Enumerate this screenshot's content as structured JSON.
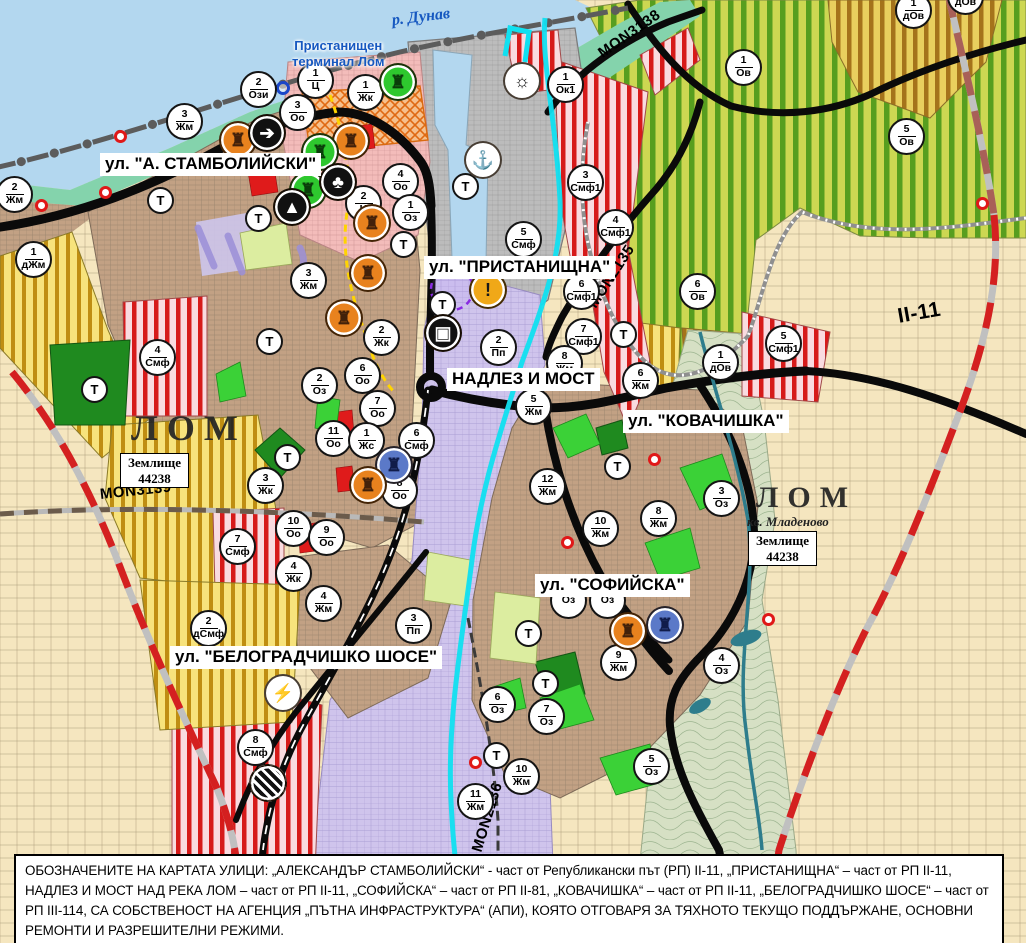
{
  "palette": {
    "water": "#b3d7ef",
    "shore_green": "#84d3ac",
    "farmland": "#f5e6bf",
    "residential_brown": "#c2a184",
    "center_pink": "#f3bcba",
    "industry_purple": "#cfc4ec",
    "mixed_red_stripe": "#d61a1a",
    "vineyard_green": "#579e1f",
    "road_black": "#0a0a0a",
    "road_red_dash": "#d42020",
    "river_cyan": "#10e0f0"
  },
  "map": {
    "labels": [
      {
        "name": "river-label",
        "cls": "lbl-river",
        "t": "р. Дунав",
        "x": 392,
        "y": 12,
        "rotate": -7
      },
      {
        "name": "port-terminal-label",
        "cls": "lbl-port",
        "t": "Пристанищен\nтерминал Лом",
        "x": 292,
        "y": 38
      },
      {
        "name": "street-label",
        "cls": "lbl-street",
        "t": "ул. \"А. СТАМБОЛИЙСКИ\"",
        "x": 100,
        "y": 153
      },
      {
        "name": "street-label",
        "cls": "lbl-street",
        "t": "ул. \"ПРИСТАНИЩНА\"",
        "x": 424,
        "y": 256
      },
      {
        "name": "street-label",
        "cls": "lbl-street",
        "t": "НАДЛЕЗ И МОСТ",
        "x": 447,
        "y": 368
      },
      {
        "name": "street-label",
        "cls": "lbl-street",
        "t": "ул. \"КОВАЧИШКА\"",
        "x": 623,
        "y": 410
      },
      {
        "name": "street-label",
        "cls": "lbl-street",
        "t": "ул. \"СОФИЙСКА\"",
        "x": 535,
        "y": 574
      },
      {
        "name": "street-label",
        "cls": "lbl-street",
        "t": "ул. \"БЕЛОГРАДЧИШКО ШОСЕ\"",
        "x": 170,
        "y": 646
      },
      {
        "name": "road-label",
        "cls": "lbl-road",
        "t": "MON3138",
        "x": 600,
        "y": 46,
        "rotate": -35
      },
      {
        "name": "road-label",
        "cls": "lbl-road",
        "t": "MON2135",
        "x": 592,
        "y": 298,
        "rotate": -57
      },
      {
        "name": "road-label",
        "cls": "lbl-road lbl-road-xl",
        "t": "II-11",
        "x": 898,
        "y": 305,
        "rotate": -10
      },
      {
        "name": "road-label",
        "cls": "lbl-road",
        "t": "MON3139",
        "x": 100,
        "y": 486,
        "rotate": -6
      },
      {
        "name": "road-label",
        "cls": "lbl-road",
        "t": "MON2136",
        "x": 477,
        "y": 843,
        "rotate": -73
      },
      {
        "name": "city-label",
        "cls": "lbl-city",
        "t": "ЛОМ",
        "x": 131,
        "y": 408,
        "size": 36
      },
      {
        "name": "city-label",
        "cls": "lbl-city",
        "t": "ЛОМ",
        "x": 756,
        "y": 481,
        "size": 30
      },
      {
        "name": "district-label",
        "cls": "lbl-district",
        "t": "кв. Младеново",
        "x": 747,
        "y": 515
      },
      {
        "name": "landplot-label",
        "cls": "lbl-plot",
        "t": "Землище\n44238",
        "x": 120,
        "y": 453
      },
      {
        "name": "landplot-label",
        "cls": "lbl-plot",
        "t": "Землище\n44238",
        "x": 748,
        "y": 531
      }
    ],
    "zone_markers": [
      {
        "num": "2",
        "code": "Ози",
        "x": 258,
        "y": 89
      },
      {
        "num": "1",
        "code": "Ц",
        "x": 315,
        "y": 80
      },
      {
        "num": "1",
        "code": "Жк",
        "x": 365,
        "y": 92
      },
      {
        "num": "3",
        "code": "Оо",
        "x": 297,
        "y": 112
      },
      {
        "num": "3",
        "code": "Жм",
        "x": 184,
        "y": 121
      },
      {
        "num": "2",
        "code": "Жм",
        "x": 14,
        "y": 194
      },
      {
        "num": "1",
        "code": "дЖм",
        "x": 33,
        "y": 259
      },
      {
        "num": "4",
        "code": "Оо",
        "x": 400,
        "y": 181
      },
      {
        "num": "2",
        "code": "Ц",
        "x": 363,
        "y": 203
      },
      {
        "num": "1",
        "code": "Оз",
        "x": 410,
        "y": 212
      },
      {
        "num": "1",
        "code": "Ок1",
        "x": 565,
        "y": 84
      },
      {
        "num": "3",
        "code": "Смф1",
        "x": 585,
        "y": 182
      },
      {
        "num": "4",
        "code": "Смф1",
        "x": 615,
        "y": 227
      },
      {
        "num": "5",
        "code": "Смф",
        "x": 523,
        "y": 239
      },
      {
        "num": "1",
        "code": "Ов",
        "x": 743,
        "y": 67
      },
      {
        "num": "1",
        "code": "дОв",
        "x": 913,
        "y": 10
      },
      {
        "num": "1",
        "code": "дОв",
        "x": 965,
        "y": -4
      },
      {
        "num": "5",
        "code": "Ов",
        "x": 906,
        "y": 136
      },
      {
        "num": "6",
        "code": "Ов",
        "x": 697,
        "y": 291
      },
      {
        "num": "6",
        "code": "Смф1",
        "x": 581,
        "y": 291
      },
      {
        "num": "7",
        "code": "Смф1",
        "x": 583,
        "y": 336
      },
      {
        "num": "5",
        "code": "Смф1",
        "x": 783,
        "y": 343
      },
      {
        "num": "1",
        "code": "дОв",
        "x": 720,
        "y": 362
      },
      {
        "num": "6",
        "code": "Жм",
        "x": 640,
        "y": 380
      },
      {
        "num": "2",
        "code": "Пп",
        "x": 498,
        "y": 347
      },
      {
        "num": "8",
        "code": "Жм",
        "x": 564,
        "y": 363
      },
      {
        "num": "5",
        "code": "Жм",
        "x": 533,
        "y": 406
      },
      {
        "num": "12",
        "code": "Жм",
        "x": 547,
        "y": 486
      },
      {
        "num": "8",
        "code": "Жм",
        "x": 658,
        "y": 518
      },
      {
        "num": "3",
        "code": "Оз",
        "x": 721,
        "y": 498
      },
      {
        "num": "10",
        "code": "Жм",
        "x": 600,
        "y": 528
      },
      {
        "num": "2",
        "code": "Жк",
        "x": 381,
        "y": 337
      },
      {
        "num": "6",
        "code": "Оо",
        "x": 362,
        "y": 375
      },
      {
        "num": "2",
        "code": "Оз",
        "x": 319,
        "y": 385
      },
      {
        "num": "7",
        "code": "Оо",
        "x": 377,
        "y": 408
      },
      {
        "num": "11",
        "code": "Оо",
        "x": 333,
        "y": 438
      },
      {
        "num": "1",
        "code": "Жс",
        "x": 366,
        "y": 440
      },
      {
        "num": "6",
        "code": "Смф",
        "x": 416,
        "y": 440
      },
      {
        "num": "8",
        "code": "Оо",
        "x": 399,
        "y": 490
      },
      {
        "num": "3",
        "code": "Жк",
        "x": 265,
        "y": 485
      },
      {
        "num": "3",
        "code": "Жм",
        "x": 308,
        "y": 280
      },
      {
        "num": "10",
        "code": "Оо",
        "x": 293,
        "y": 528
      },
      {
        "num": "9",
        "code": "Оо",
        "x": 326,
        "y": 537
      },
      {
        "num": "4",
        "code": "Жк",
        "x": 293,
        "y": 573
      },
      {
        "num": "4",
        "code": "Жм",
        "x": 323,
        "y": 603
      },
      {
        "num": "7",
        "code": "Смф",
        "x": 237,
        "y": 546
      },
      {
        "num": "4",
        "code": "Смф",
        "x": 157,
        "y": 357
      },
      {
        "num": "2",
        "code": "дСмф",
        "x": 208,
        "y": 628
      },
      {
        "num": "3",
        "code": "Пп",
        "x": 413,
        "y": 625
      },
      {
        "num": "8",
        "code": "Смф",
        "x": 255,
        "y": 747
      },
      {
        "num": "9",
        "code": "Жм",
        "x": 618,
        "y": 662
      },
      {
        "num": "4",
        "code": "Оз",
        "x": 721,
        "y": 665
      },
      {
        "num": "6",
        "code": "Оз",
        "x": 497,
        "y": 704
      },
      {
        "num": "7",
        "code": "Оз",
        "x": 546,
        "y": 716
      },
      {
        "num": "10",
        "code": "Жм",
        "x": 521,
        "y": 776
      },
      {
        "num": "11",
        "code": "Жм",
        "x": 475,
        "y": 801
      },
      {
        "num": "5",
        "code": "Оз",
        "x": 651,
        "y": 766
      },
      {
        "num": "",
        "code": "Оз",
        "x": 568,
        "y": 600
      },
      {
        "num": "",
        "code": "Оз",
        "x": 607,
        "y": 600
      }
    ],
    "t_markers": [
      {
        "t": "Т",
        "x": 160,
        "y": 200
      },
      {
        "t": "Т",
        "x": 258,
        "y": 218
      },
      {
        "t": "Т",
        "x": 94,
        "y": 389
      },
      {
        "t": "Т",
        "x": 287,
        "y": 457
      },
      {
        "t": "Т",
        "x": 269,
        "y": 341
      },
      {
        "t": "Т",
        "x": 403,
        "y": 244
      },
      {
        "t": "Т",
        "x": 442,
        "y": 304
      },
      {
        "t": "Т",
        "x": 465,
        "y": 186
      },
      {
        "t": "Т",
        "x": 623,
        "y": 334
      },
      {
        "t": "Т",
        "x": 617,
        "y": 466
      },
      {
        "t": "Т",
        "x": 528,
        "y": 633
      },
      {
        "t": "Т",
        "x": 545,
        "y": 683
      },
      {
        "t": "Т",
        "x": 496,
        "y": 755
      }
    ],
    "icon_markers": [
      {
        "name": "monument-icon",
        "glyph": "♜",
        "bg": "#e8821e",
        "fg": "#42210a",
        "x": 238,
        "y": 140
      },
      {
        "name": "monument-icon",
        "glyph": "♜",
        "bg": "#e8821e",
        "fg": "#42210a",
        "x": 351,
        "y": 141
      },
      {
        "name": "monument-icon",
        "glyph": "♜",
        "bg": "#e8821e",
        "fg": "#42210a",
        "x": 372,
        "y": 223
      },
      {
        "name": "monument-icon",
        "glyph": "♜",
        "bg": "#e8821e",
        "fg": "#42210a",
        "x": 368,
        "y": 273
      },
      {
        "name": "monument-icon",
        "glyph": "♜",
        "bg": "#e8821e",
        "fg": "#42210a",
        "x": 344,
        "y": 318
      },
      {
        "name": "monument-icon",
        "glyph": "♜",
        "bg": "#2ec82e",
        "fg": "#0a3d0a",
        "x": 398,
        "y": 82
      },
      {
        "name": "monument-icon",
        "glyph": "♜",
        "bg": "#2ec82e",
        "fg": "#0a3d0a",
        "x": 320,
        "y": 152
      },
      {
        "name": "monument-icon",
        "glyph": "♜",
        "bg": "#2ec82e",
        "fg": "#0a3d0a",
        "x": 308,
        "y": 190
      },
      {
        "name": "key-site-icon",
        "glyph": "➔",
        "bg": "#111111",
        "fg": "#ffffff",
        "x": 267,
        "y": 133
      },
      {
        "name": "people-site-icon",
        "glyph": "♣",
        "bg": "#111111",
        "fg": "#ffffff",
        "x": 338,
        "y": 182
      },
      {
        "name": "cave-site-icon",
        "glyph": "▲",
        "bg": "#111111",
        "fg": "#ffffff",
        "x": 292,
        "y": 207
      },
      {
        "name": "anchor-port-icon",
        "glyph": "⚓",
        "bg": "#ffffff",
        "fg": "#111111",
        "x": 483,
        "y": 160
      },
      {
        "name": "sun-site-icon",
        "glyph": "☼",
        "bg": "#ffffff",
        "fg": "#111111",
        "x": 522,
        "y": 81
      },
      {
        "name": "warning-icon",
        "glyph": "!",
        "bg": "#f0a818",
        "fg": "#1a1a1a",
        "x": 488,
        "y": 290
      },
      {
        "name": "truck-terminal-icon",
        "glyph": "▣",
        "bg": "#111111",
        "fg": "#ffffff",
        "x": 443,
        "y": 333
      },
      {
        "name": "monument-icon",
        "glyph": "♜",
        "bg": "#5b79c8",
        "fg": "#101c4a",
        "x": 394,
        "y": 465
      },
      {
        "name": "monument-icon",
        "glyph": "♜",
        "bg": "#e8821e",
        "fg": "#42210a",
        "x": 368,
        "y": 485
      },
      {
        "name": "monument-icon",
        "glyph": "♜",
        "bg": "#5b79c8",
        "fg": "#101c4a",
        "x": 665,
        "y": 625
      },
      {
        "name": "monument-icon",
        "glyph": "♜",
        "bg": "#e8821e",
        "fg": "#42210a",
        "x": 628,
        "y": 631
      },
      {
        "name": "lightning-icon",
        "glyph": "⚡",
        "bg": "#ffffff",
        "fg": "#111111",
        "x": 283,
        "y": 693
      },
      {
        "name": "railway-crossing-icon",
        "glyph": "",
        "cls": "icon-stripes",
        "bg": "#111111",
        "fg": "#ffffff",
        "x": 268,
        "y": 783
      }
    ],
    "point_markers": [
      {
        "name": "road-point",
        "cls": "ring-red",
        "x": 121,
        "y": 137
      },
      {
        "name": "road-point",
        "cls": "ring-red",
        "x": 106,
        "y": 193
      },
      {
        "name": "road-point",
        "cls": "ring-red",
        "x": 42,
        "y": 206
      },
      {
        "name": "road-point",
        "cls": "ring-red",
        "x": 655,
        "y": 460
      },
      {
        "name": "road-point",
        "cls": "ring-red",
        "x": 568,
        "y": 543
      },
      {
        "name": "road-point",
        "cls": "ring-red",
        "x": 476,
        "y": 763
      },
      {
        "name": "road-point",
        "cls": "ring-red",
        "x": 769,
        "y": 620
      },
      {
        "name": "road-point",
        "cls": "ring-red",
        "x": 983,
        "y": 204
      },
      {
        "name": "reference-point",
        "cls": "ring-blue",
        "x": 283,
        "y": 88
      }
    ]
  },
  "caption": {
    "segments": [
      {
        "b": 1,
        "t": "ОБОЗНАЧЕНИТЕ НА КАРТАТА УЛИЦИ: „АЛЕКСАНДЪР СТАМБОЛИЙСКИ“"
      },
      {
        "b": 0,
        "t": " - част от Републикански път (РП) II-11, "
      },
      {
        "b": 1,
        "t": "„ПРИСТАНИЩНА“"
      },
      {
        "b": 0,
        "t": " – част от РП II-11, "
      },
      {
        "b": 1,
        "t": "НАДЛЕЗ И МОСТ НАД РЕКА ЛОМ"
      },
      {
        "b": 0,
        "t": " – част от РП II-11, "
      },
      {
        "b": 1,
        "t": "„СОФИЙСКА“"
      },
      {
        "b": 0,
        "t": " – част от РП II-81, "
      },
      {
        "b": 1,
        "t": "„КОВАЧИШКА“"
      },
      {
        "b": 0,
        "t": " – част от РП II-11, "
      },
      {
        "b": 1,
        "t": "„БЕЛОГРАДЧИШКО ШОСЕ“"
      },
      {
        "b": 0,
        "t": " – част от РП III-114, "
      },
      {
        "b": 1,
        "t": "СА СОБСТВЕНОСТ НА АГЕНЦИЯ „ПЪТНА ИНФРАСТРУКТУРА“ (АПИ), КОЯТО ОТГОВАРЯ ЗА ТЯХНОТО ТЕКУЩО ПОДДЪРЖАНЕ, ОСНОВНИ РЕМОНТИ И РАЗРЕШИТЕЛНИ РЕЖИМИ."
      }
    ]
  }
}
